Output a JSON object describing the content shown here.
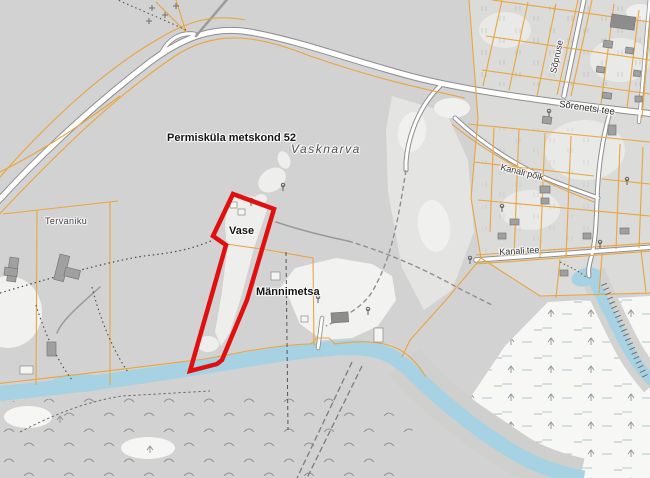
{
  "map": {
    "place_labels": {
      "forest_unit": "Permisküla metskond 52",
      "settlement": "Vasknarva",
      "parcel_vase": "Vase",
      "parcel_mannimetsa": "Männimetsa",
      "farm_tervaniku": "Tervaniku"
    },
    "road_labels": {
      "sorenetsi_tee": "Sõrenetsi tee",
      "sopruse": "Sõpruse",
      "kanali_poik": "Kanali põik",
      "kanali_tee": "Kanali tee"
    },
    "legend": {
      "selected_parcel_color": "#e01010",
      "cadastral_line_color": "#eaa53e",
      "water_color": "#a7d2e4",
      "forest_color": "#d2d2d2",
      "open_land_color": "#e4e4e2",
      "wetland_color": "#f7f7f5",
      "road_fill_color": "#ffffff",
      "road_casing_color": "#8e8e8e",
      "building_color": "#9c9c9c"
    }
  }
}
